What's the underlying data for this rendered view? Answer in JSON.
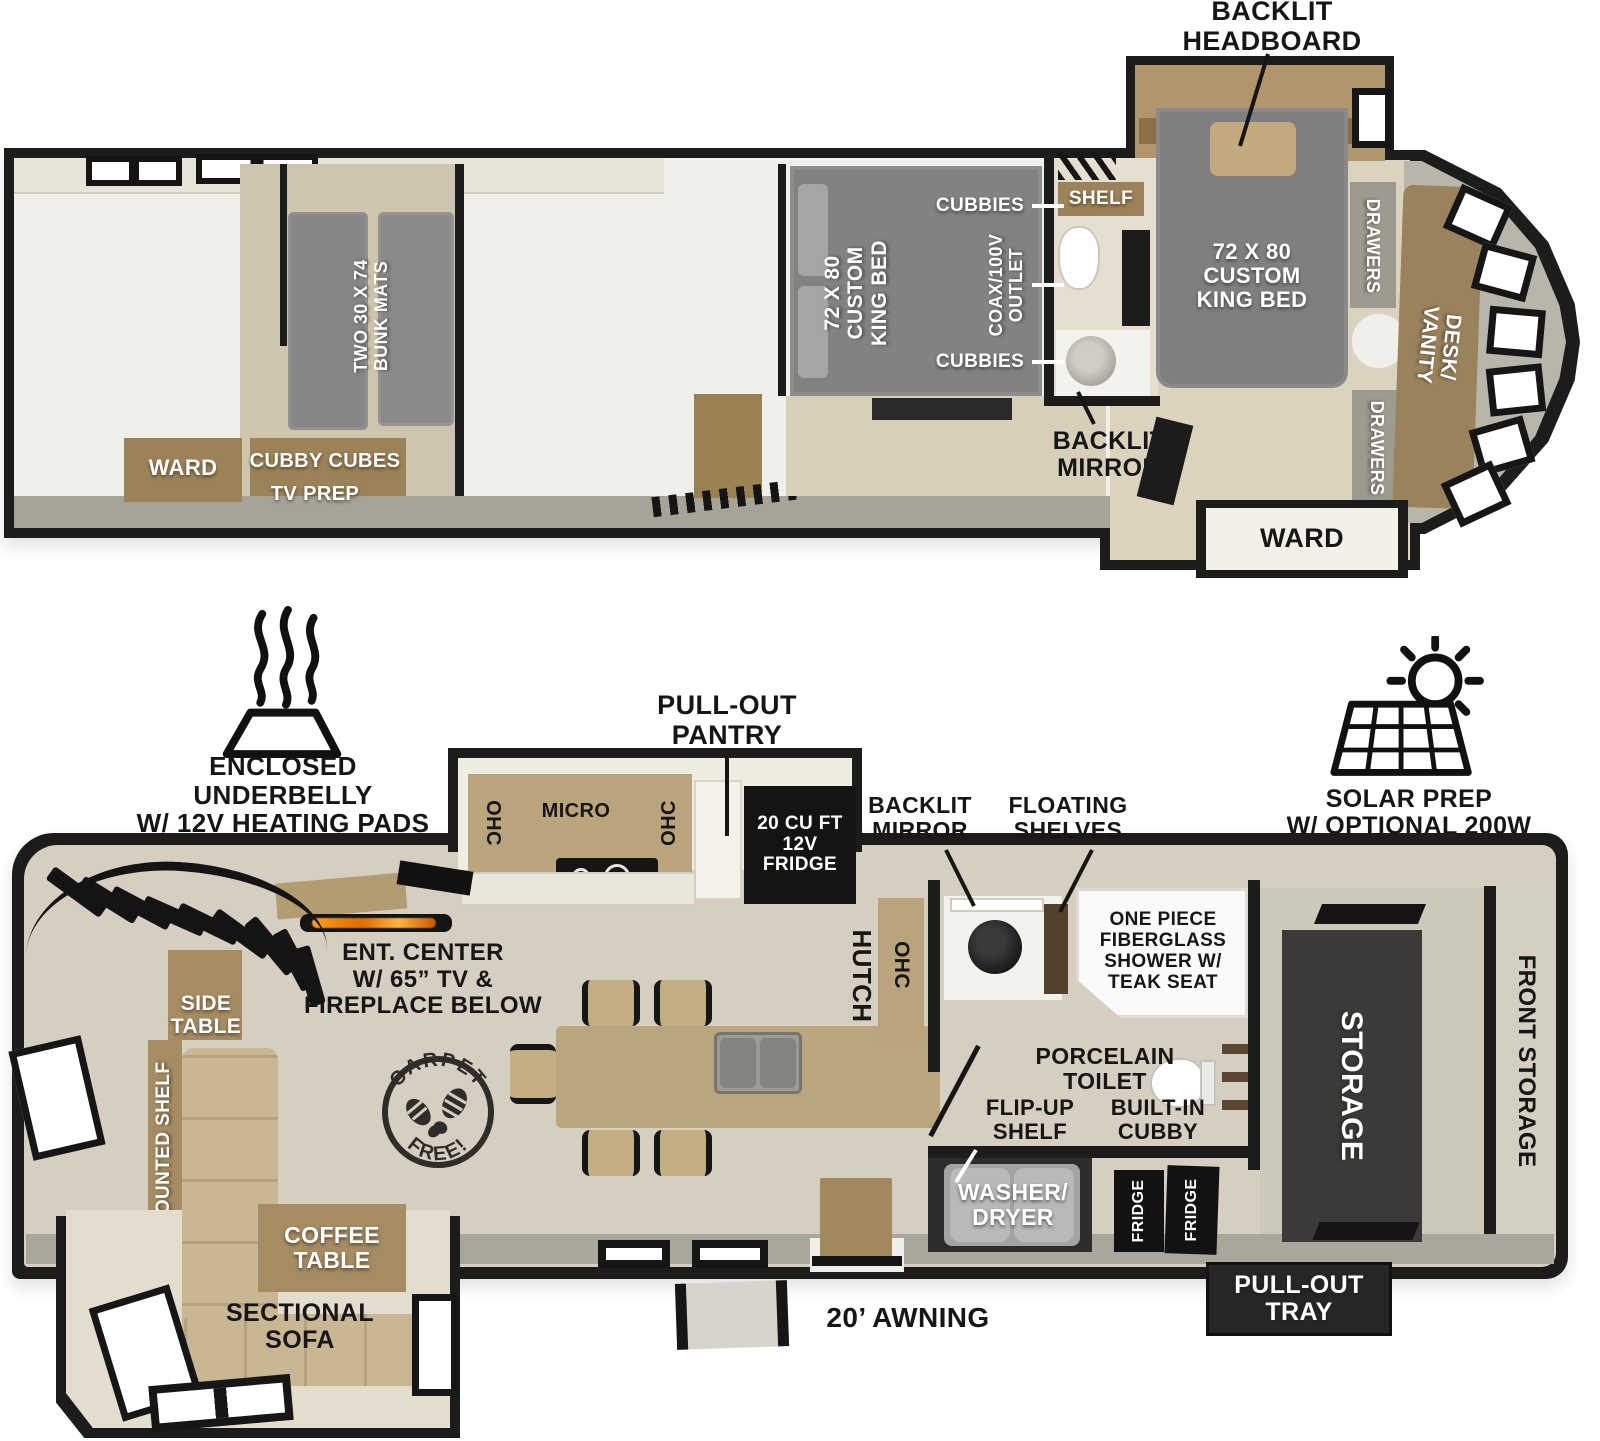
{
  "upper_deck": {
    "backlit_headboard": "BACKLIT\nHEADBOARD",
    "master_bed": "72 X 80\nCUSTOM\nKING BED",
    "drawers": "DRAWERS",
    "desk_vanity": "DESK/\nVANITY",
    "ward": "WARD",
    "shelf": "SHELF",
    "backlit_mirror": "BACKLIT\nMIRROR",
    "cubbies": "CUBBIES",
    "coax_outlet": "COAX/100V\nOUTLET",
    "rear_bed": "72 X 80\nCUSTOM\nKING BED",
    "bunk_mats": "TWO 30 X 74\nBUNK MATS",
    "bunk_ward": "WARD",
    "cubby_cubes": "CUBBY CUBES",
    "tv_prep": "TV PREP"
  },
  "main_deck": {
    "underbelly": "ENCLOSED UNDERBELLY\nW/ 12V HEATING PADS",
    "pull_out_pantry": "PULL-OUT\nPANTRY",
    "solar": "SOLAR PREP\nW/ OPTIONAL 200W\nSOLAR PACKAGE",
    "ohc": "OHC",
    "micro": "MICRO",
    "fridge_12v": "20 CU FT\n12V\nFRIDGE",
    "hutch": "HUTCH",
    "backlit_mirror": "BACKLIT\nMIRROR",
    "floating_shelves": "FLOATING\nSHELVES",
    "shower": "ONE PIECE\nFIBERGLASS\nSHOWER W/\nTEAK SEAT",
    "porcelain_toilet": "PORCELAIN\nTOILET",
    "flip_up_shelf": "FLIP-UP\nSHELF",
    "built_in_cubby": "BUILT-IN\nCUBBY",
    "ent_center": "ENT. CENTER\nW/ 65” TV &\nFIREPLACE BELOW",
    "carpet_free_top": "CARPET",
    "carpet_free_bottom": "FREE!",
    "side_table": "SIDE\nTABLE",
    "mounted_shelf": "MOUNTED SHELF",
    "coffee_table": "COFFEE\nTABLE",
    "sectional_sofa": "SECTIONAL\nSOFA",
    "washer_dryer": "WASHER/\nDRYER",
    "fridge_small": "FRIDGE",
    "storage": "STORAGE",
    "front_storage": "FRONT STORAGE",
    "pull_out_tray": "PULL-OUT\nTRAY",
    "awning": "20’ AWNING"
  },
  "colors": {
    "wall": "#1c1c1b",
    "wall_trim": "#b5b2a8",
    "floor_light": "#f0efe9",
    "floor_wood": "#d6cec0",
    "mattress_gray": "#868686",
    "cabinet_wood": "#a28b64",
    "storage_dark": "#3b3a38",
    "appliance_black": "#141414",
    "sofa_tan": "#c9b794",
    "flame_orange": "#e8860f"
  }
}
